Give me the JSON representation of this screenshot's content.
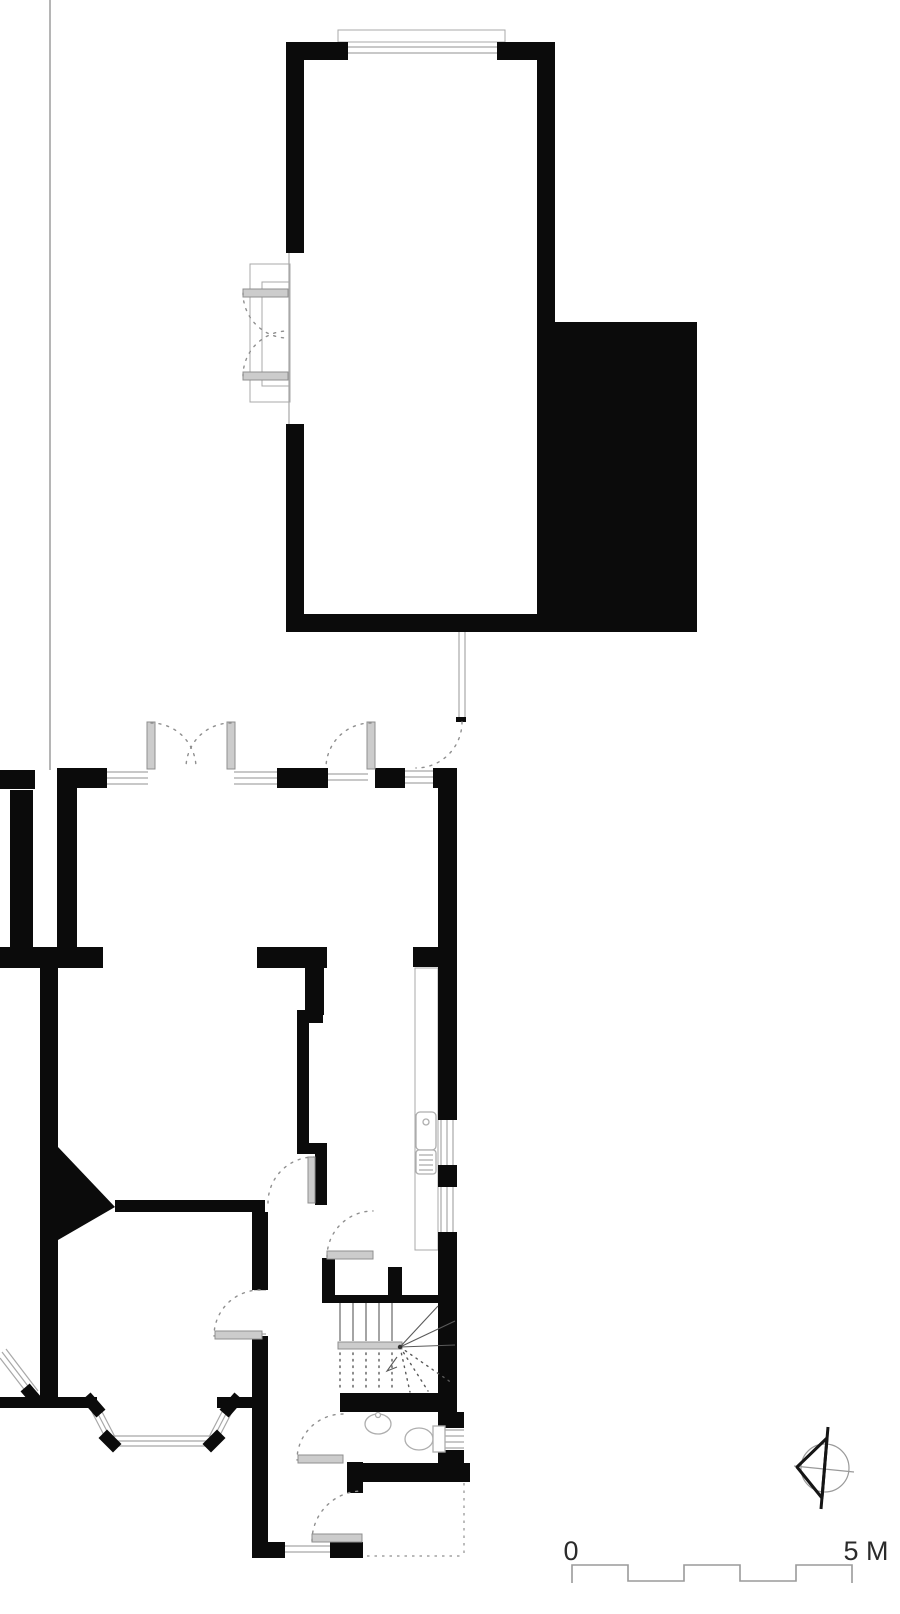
{
  "plan": {
    "type": "architectural-ground-floor-plan",
    "scale_bar": {
      "zero_label": "0",
      "end_label": "5 M",
      "total_meters": 5,
      "divisions": 5
    },
    "compass": {
      "icon": "north-arrow",
      "direction": "pointing-left"
    },
    "colors": {
      "wall": "#0b0b0b",
      "thin_line": "#a8a8a8",
      "door_leaf": "#cccccc",
      "swing_arc": "#8f8f8f",
      "fixture": "#aeaeae",
      "stair_line": "#5a5a5a",
      "scale_line": "#9a9a9a",
      "label_text": "#2b2b2b",
      "boundary_line": "#b5b5b5"
    }
  }
}
